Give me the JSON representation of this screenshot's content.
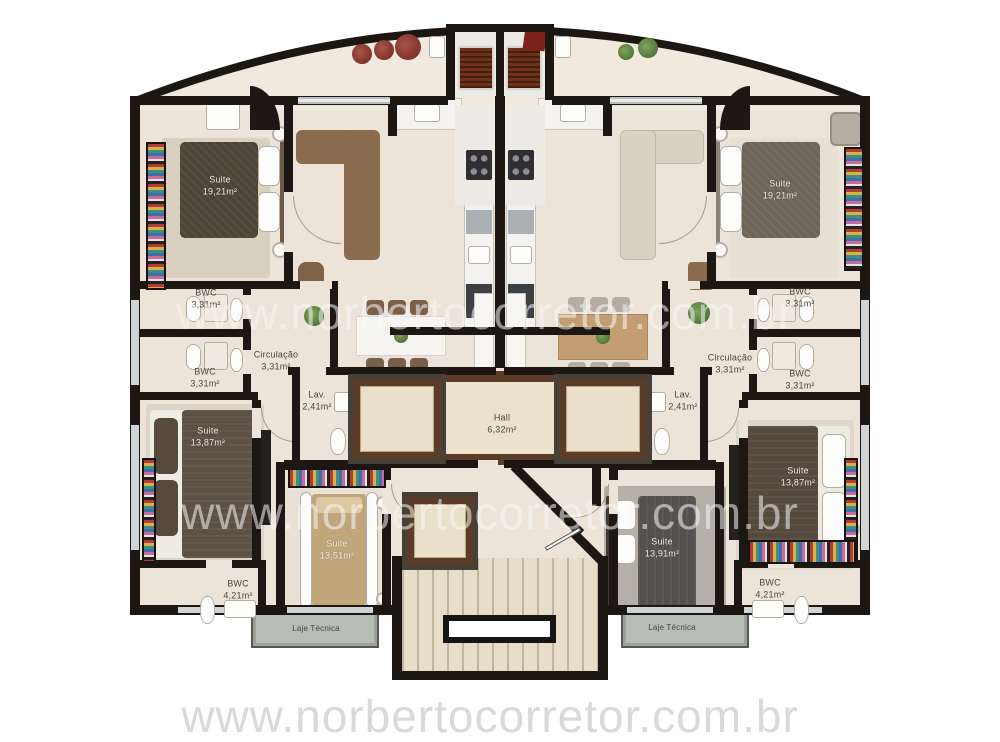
{
  "watermark": {
    "text": "www.norbertocorretor.com.br"
  },
  "rooms": {
    "suite_top_left": {
      "label": "Suite",
      "area": "19,21m²"
    },
    "suite_top_right": {
      "label": "Suite",
      "area": "19,21m²"
    },
    "bwc_left_upper": {
      "label": "BWC",
      "area": "3,31m²"
    },
    "bwc_left_lower": {
      "label": "BWC",
      "area": "3,31m²"
    },
    "bwc_right_upper": {
      "label": "BWC",
      "area": "3,31m²"
    },
    "bwc_right_lower": {
      "label": "BWC",
      "area": "3,31m²"
    },
    "circulacao_left": {
      "label": "Circulação",
      "area": "3,31m²"
    },
    "circulacao_right": {
      "label": "Circulação",
      "area": "3,31m²"
    },
    "lav_left": {
      "label": "Lav.",
      "area": "2,41m²"
    },
    "lav_right": {
      "label": "Lav.",
      "area": "2,41m²"
    },
    "hall": {
      "label": "Hall",
      "area": "6,32m²"
    },
    "suite_mid_left": {
      "label": "Suite",
      "area": "13,87m²"
    },
    "suite_mid_right": {
      "label": "Suite",
      "area": "13,87m²"
    },
    "suite_bottom_left": {
      "label": "Suite",
      "area": "13,51m²"
    },
    "suite_bottom_right": {
      "label": "Suite",
      "area": "13,91m²"
    },
    "bwc_bottom_left": {
      "label": "BWC",
      "area": "4,21m²"
    },
    "bwc_bottom_right": {
      "label": "BWC",
      "area": "4,21m²"
    },
    "laje_left": {
      "label": "Laje Técnica"
    },
    "laje_right": {
      "label": "Laje Técnica"
    }
  },
  "colors": {
    "wall": "#1c1712",
    "floor": "#ece4d8",
    "terrace": "#f1e9de",
    "marble_dark": "#5a3c28",
    "marble_light": "#eadfc8",
    "laje_strip": "#b6bdb5",
    "watermark": "#d9d9d9"
  }
}
